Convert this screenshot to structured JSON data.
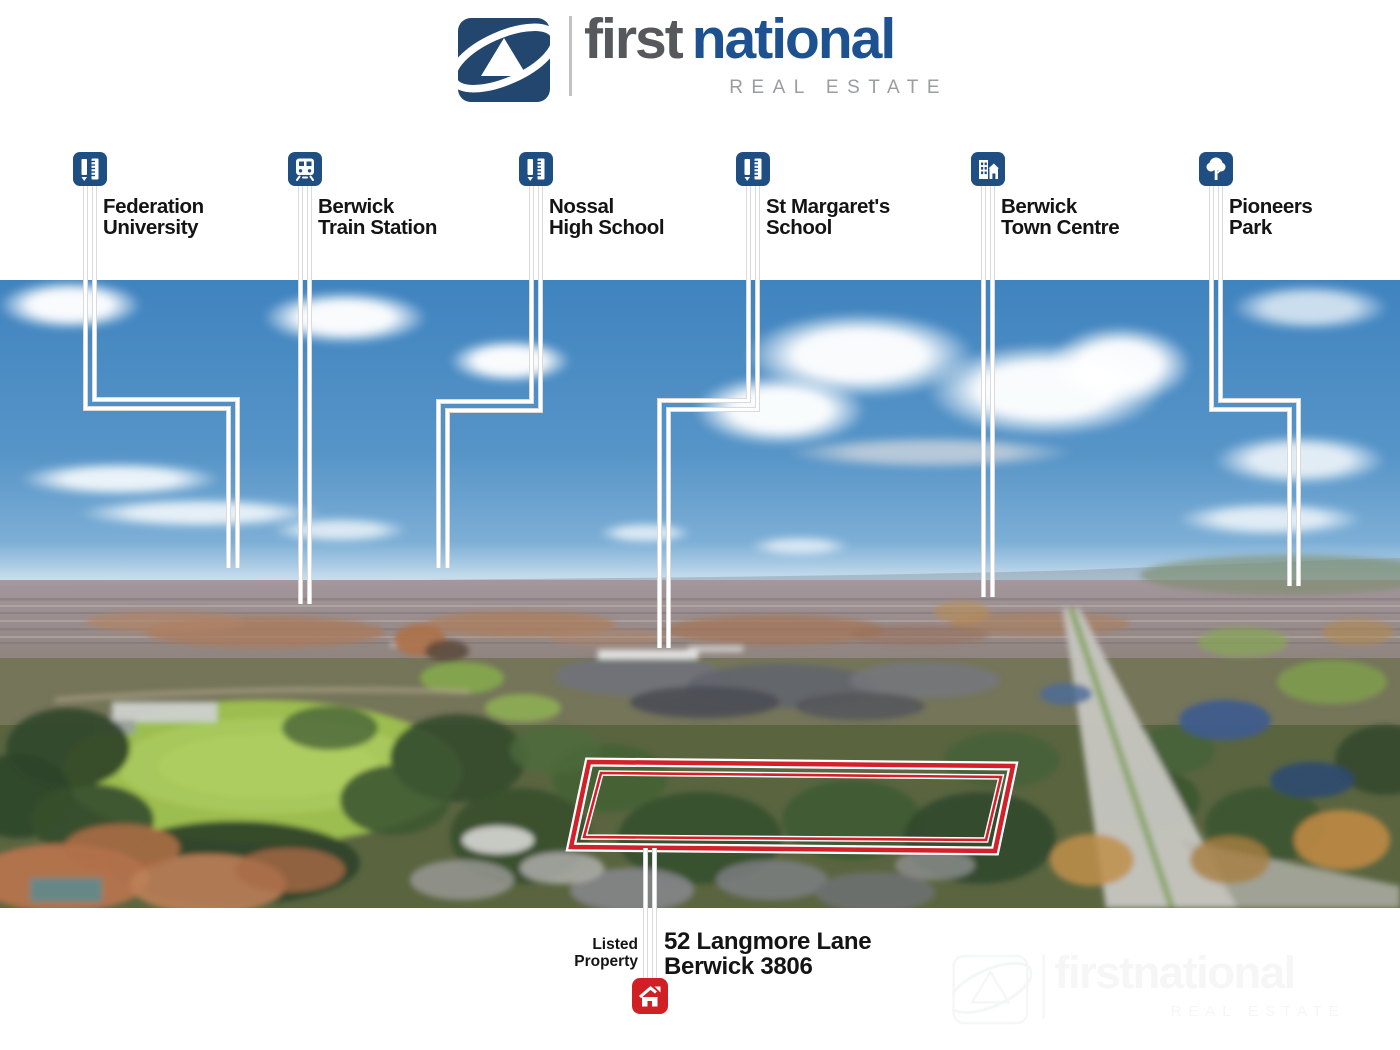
{
  "logo": {
    "word1": "first",
    "word2": "national",
    "tagline": "REAL ESTATE"
  },
  "markers": [
    {
      "drive": "Drive",
      "time": "4min",
      "name": [
        "Federation",
        "University"
      ],
      "icon": "education-icon"
    },
    {
      "drive": "Drive",
      "time": "3min",
      "name": [
        "Berwick",
        "Train Station"
      ],
      "icon": "train-icon"
    },
    {
      "drive": "Drive",
      "time": "4min",
      "name": [
        "Nossal",
        "High School"
      ],
      "icon": "education-icon"
    },
    {
      "drive": "Drive",
      "time": "2min",
      "name": [
        "St Margaret's",
        "School"
      ],
      "icon": "education-icon"
    },
    {
      "drive": "Drive",
      "time": "2min",
      "name": [
        "Berwick",
        "Town Centre"
      ],
      "icon": "town-centre-icon"
    },
    {
      "drive": "Drive",
      "time": "3min",
      "name": [
        "Pioneers",
        "Park"
      ],
      "icon": "park-tree-icon"
    }
  ],
  "listed_property": {
    "label": [
      "Listed",
      "Property"
    ],
    "address": [
      "52 Langmore Lane",
      "Berwick 3806"
    ]
  },
  "watermark": {
    "word1": "first",
    "word2": "national",
    "tagline": "REAL ESTATE"
  },
  "colors": {
    "logo_navy": "#23466e",
    "logo_blue": "#1e518f",
    "brand_gray": "#57585c",
    "tagline_gray": "#9a9da0",
    "sign_blue": "#1f4e82",
    "boundary_red": "#d3202a",
    "house_red": "#d11f26",
    "text_black": "#141414"
  }
}
